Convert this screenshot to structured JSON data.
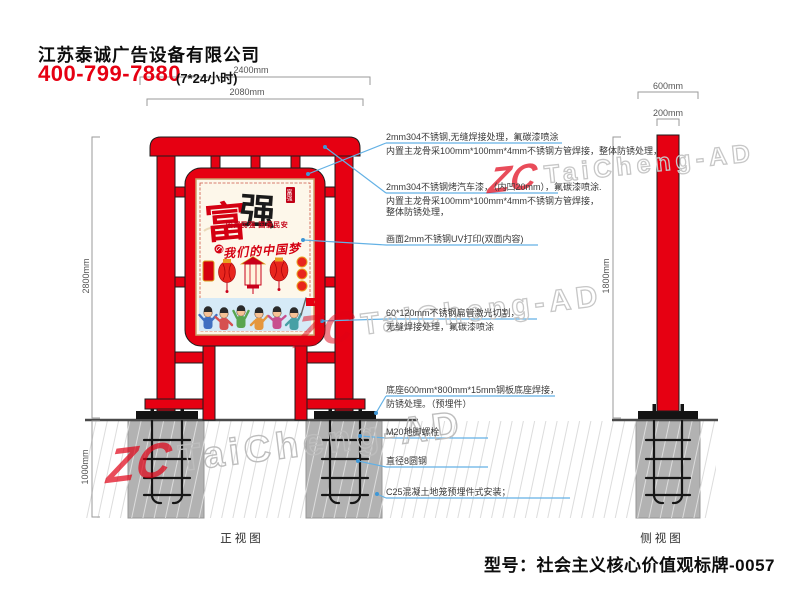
{
  "header": {
    "company_name": "江苏泰诚广告设备有限公司",
    "phone": "400-799-7880",
    "service_hours": "(7*24小时)"
  },
  "watermark": {
    "logo": "ZC",
    "brand": "TaiCheng-AD"
  },
  "front_view": {
    "label": "正视图",
    "dim_outer_width": "2400mm",
    "dim_inner_width": "2080mm",
    "dim_height": "2800mm",
    "dim_foundation_depth": "1000mm"
  },
  "side_view": {
    "label": "侧视图",
    "dim_base_width": "600mm",
    "dim_pole_width": "200mm",
    "dim_height": "1800mm"
  },
  "poster": {
    "char_left": "富",
    "char_right": "强",
    "seal_text": "富强",
    "subtitle": "国富民强 国泰民安",
    "calligraphy": "我们的中国梦"
  },
  "annotations": [
    {
      "line1": "2mm304不锈钢,无缝焊接处理，氟碳漆喷涂",
      "line2": "内置主龙骨采100mm*100mm*4mm不锈钢方管焊接，整体防锈处理，",
      "line3": ""
    },
    {
      "line1": "2mm304不锈钢烤汽车漆，（内凹20mm），氟碳漆喷涂.",
      "line2": "内置主龙骨采100mm*100mm*4mm不锈钢方管焊接，",
      "line3": "整体防锈处理，"
    },
    {
      "line1": "画面2mm不锈钢UV打印(双面内容)",
      "line2": "",
      "line3": ""
    },
    {
      "line1": "60*120mm不锈钢扁管激光切割，",
      "line2": "无缝焊接处理，氟碳漆喷涂",
      "line3": ""
    },
    {
      "line1": "底座600mm*800mm*15mm钢板底座焊接，",
      "line2": "防锈处理。（预埋件）",
      "line3": ""
    },
    {
      "line1": "M20地脚螺栓",
      "line2": "",
      "line3": ""
    },
    {
      "line1": "直径8圆钢",
      "line2": "",
      "line3": ""
    },
    {
      "line1": "C25混凝土地笼预埋件式安装；",
      "line2": "",
      "line3": ""
    }
  ],
  "footer": {
    "model_label": "型号：社会主义核心价值观标牌-0057"
  },
  "colors": {
    "accent_red": "#e60012",
    "leader_blue": "#63b1e5",
    "concrete_gray": "#b2b2b2"
  }
}
